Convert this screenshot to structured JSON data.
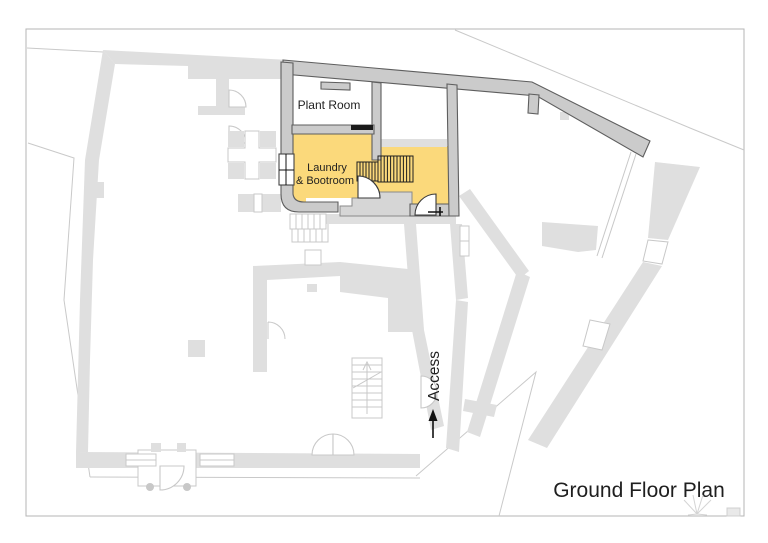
{
  "drawing": {
    "title": "Ground Floor Plan"
  },
  "rooms": {
    "plant_room": "Plant Room",
    "laundry_line1": "Laundry",
    "laundry_line2": "& Bootroom"
  },
  "annotations": {
    "access": "Access"
  },
  "colors": {
    "highlight": "#FBD97B",
    "wall_fill": "#CBCBCB",
    "wall_stroke": "#5E5E5E",
    "existing": "#DFDFDF",
    "existing_outline": "#C8C8C8",
    "boundary": "#C9C9C9",
    "frame": "#B5B5B5",
    "text": "#1F1F1F"
  }
}
